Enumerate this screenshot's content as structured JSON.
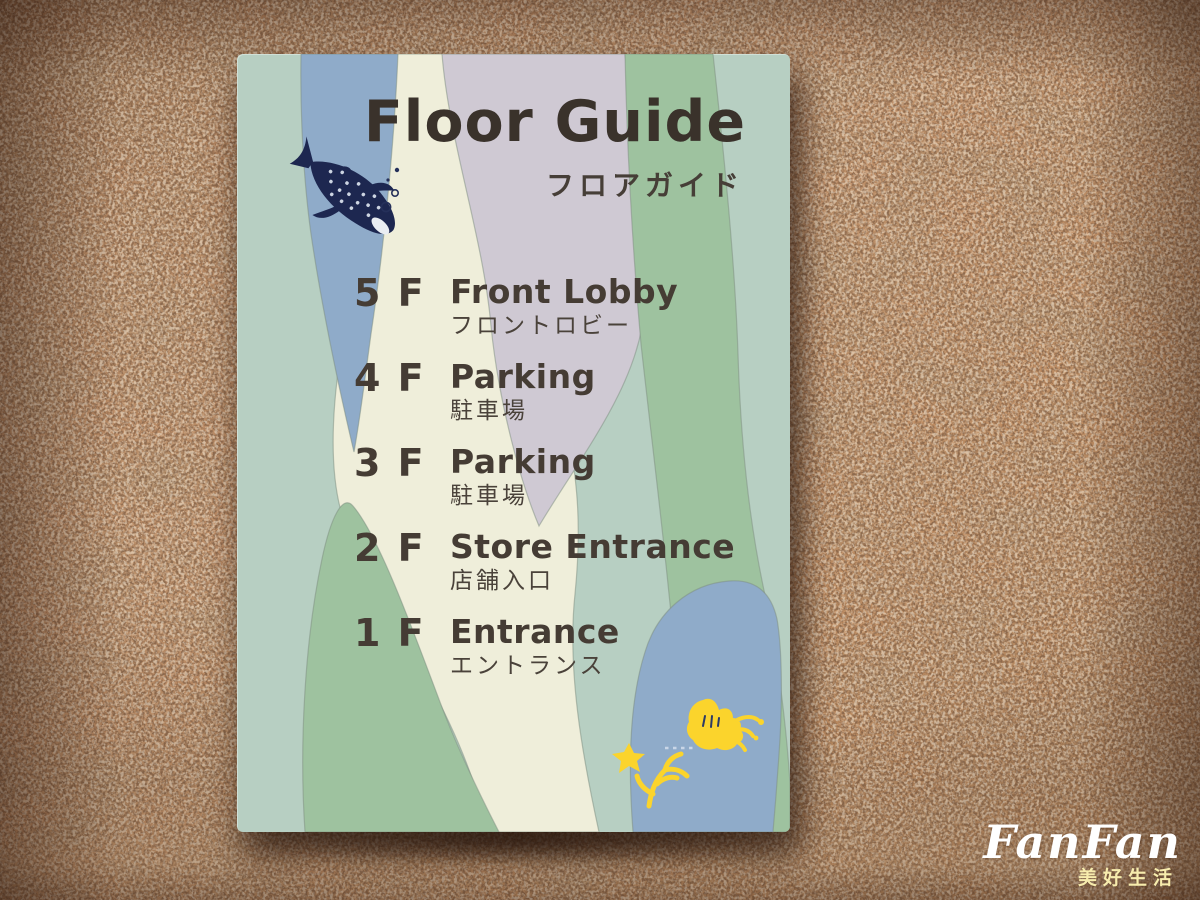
{
  "sign": {
    "title": "Floor Guide",
    "subtitle_jp": "フロアガイド",
    "floors": [
      {
        "number": "5 F",
        "label_en": "Front Lobby",
        "label_jp": "フロントロビー"
      },
      {
        "number": "4 F",
        "label_en": "Parking",
        "label_jp": "駐車場"
      },
      {
        "number": "3 F",
        "label_en": "Parking",
        "label_jp": "駐車場"
      },
      {
        "number": "2 F",
        "label_en": "Store Entrance",
        "label_jp": "店舗入口"
      },
      {
        "number": "1 F",
        "label_en": "Entrance",
        "label_jp": "エントランス"
      }
    ],
    "illustrations": [
      "whale-shark-icon",
      "bubbles-icon",
      "coral-starfish-icon",
      "coral-anemone-icon"
    ],
    "colors": {
      "seafoam": "#b7cfc2",
      "blue": "#8fabc9",
      "cream": "#efeeda",
      "lavender": "#cfc9d3",
      "green": "#9ec29f",
      "text": "#453c34",
      "whale_navy": "#1d2750",
      "coral_yellow": "#fbd42c"
    }
  },
  "watermark": {
    "name": "FanFan",
    "tagline": "美好生活"
  },
  "scene": {
    "wall": "granite"
  }
}
